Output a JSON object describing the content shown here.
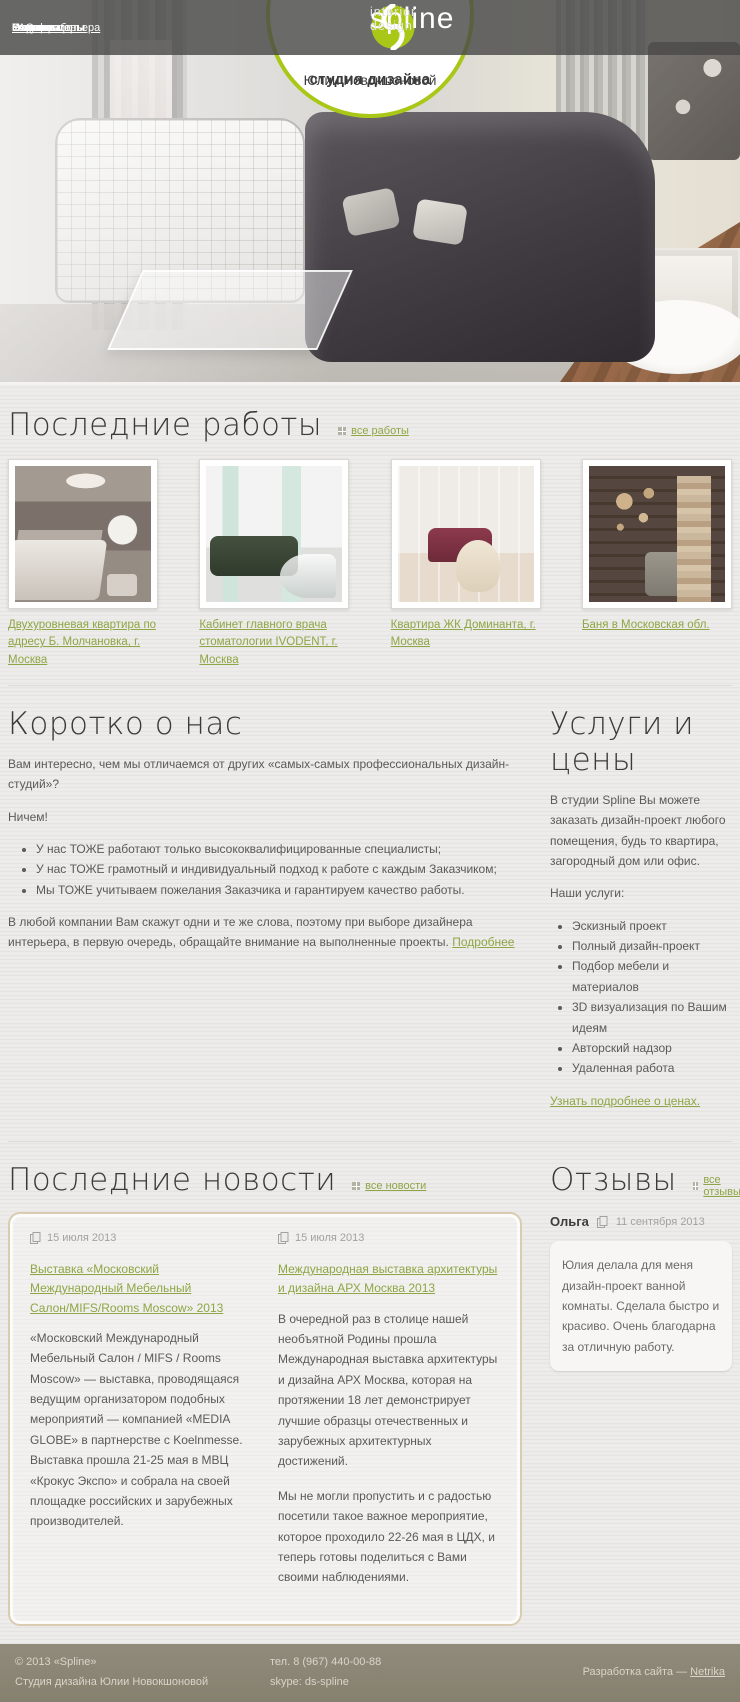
{
  "brand": {
    "name": "spline",
    "tagline": "interior design",
    "circle_line1": "студия дизайна",
    "circle_line2": "Юлии Новокшоновой"
  },
  "colors": {
    "accent_green": "#a9c717",
    "link_green": "#8ea645",
    "footer_bg": "#8b8576",
    "nav_bg": "rgba(73,73,72,0.82)"
  },
  "nav": {
    "left": [
      {
        "label": "О нас"
      },
      {
        "label": "Услуги и цены"
      },
      {
        "label": "FAQ"
      },
      {
        "label": "Этапы работы"
      },
      {
        "label": "Портфолио"
      }
    ],
    "right": [
      {
        "label": "Стили интерьера"
      },
      {
        "label": "Новости"
      },
      {
        "label": "Статьи"
      },
      {
        "label": "Отзывы"
      },
      {
        "label": "Контакты"
      }
    ]
  },
  "works": {
    "title": "Последние работы",
    "all_link": "все работы",
    "items": [
      {
        "caption": "Двухуровневая квартира по адресу Б. Молчановка, г. Москва"
      },
      {
        "caption": "Кабинет главного врача стоматологии IVODENT, г. Москва"
      },
      {
        "caption": "Квартира ЖК Доминанта, г. Москва"
      },
      {
        "caption": "Баня в Московская обл."
      }
    ]
  },
  "about": {
    "title": "Коротко о нас",
    "intro": "Вам интересно, чем мы отличаемся от других «самых-самых профессиональных дизайн-студий»?",
    "nothing": "Ничем!",
    "bullets": [
      "У нас ТОЖЕ работают только высококвалифицированные специалисты;",
      "У нас ТОЖЕ грамотный и индивидуальный подход к работе с каждым Заказчиком;",
      "Мы ТОЖЕ учитываем пожелания Заказчика и гарантируем качество работы."
    ],
    "outro": "В любой компании Вам скажут одни и те же слова, поэтому при выборе дизайнера интерьера, в первую очередь, обращайте внимание на выполненные проекты.",
    "more_link": "Подробнее"
  },
  "services": {
    "title": "Услуги и цены",
    "intro": "В студии Spline Вы можете заказать дизайн-проект любого помещения, будь то квартира, загородный дом или офис.",
    "list_label": "Наши услуги:",
    "items": [
      "Эскизный проект",
      "Полный дизайн-проект",
      "Подбор мебели и материалов",
      "3D визуализация по Вашим идеям",
      "Авторский надзор",
      "Удаленная работа"
    ],
    "prices_link": "Узнать подробнее о ценах."
  },
  "news": {
    "title": "Последние новости",
    "all_link": "все новости",
    "items": [
      {
        "date": "15 июля 2013",
        "title": "Выставка «Московский Международный Мебельный Салон/MIFS/Rooms Moscow» 2013",
        "paragraphs": [
          "«Московский Международный Мебельный Салон / MIFS / Rooms Moscow» — выставка, проводящаяся ведущим организатором подобных мероприятий — компанией «MEDIA GLOBE» в партнерстве с Koelnmesse. Выставка прошла 21-25 мая в МВЦ «Крокус Экспо» и собрала на своей площадке российских и зарубежных производителей."
        ]
      },
      {
        "date": "15 июля 2013",
        "title": "Международная выставка архитектуры и дизайна АРХ Москва 2013",
        "paragraphs": [
          "В очередной раз в столице нашей необъятной Родины прошла Международная выставка архитектуры и дизайна АРХ Москва, которая на протяжении 18 лет демонстрирует лучшие образцы отечественных и зарубежных архитектурных достижений.",
          "Мы не могли пропустить и с радостью посетили такое важное мероприятие, которое проходило 22-26 мая в ЦДХ, и теперь готовы поделиться с Вами своими наблюдениями."
        ]
      }
    ]
  },
  "reviews": {
    "title": "Отзывы",
    "all_link": "все отзывы",
    "items": [
      {
        "author": "Ольга",
        "date": "11 сентября 2013",
        "text": "Юлия делала для меня дизайн-проект ванной комнаты. Сделала быстро и красиво. Очень благодарна за отличную работу."
      }
    ]
  },
  "footer": {
    "copyright": "© 2013 «Spline»",
    "studio": "Студия дизайна Юлии Новокшоновой",
    "phone": "тел. 8 (967) 440-00-88",
    "skype": "skype: ds-spline",
    "dev_prefix": "Разработка сайта — ",
    "dev_link": "Netrika"
  }
}
